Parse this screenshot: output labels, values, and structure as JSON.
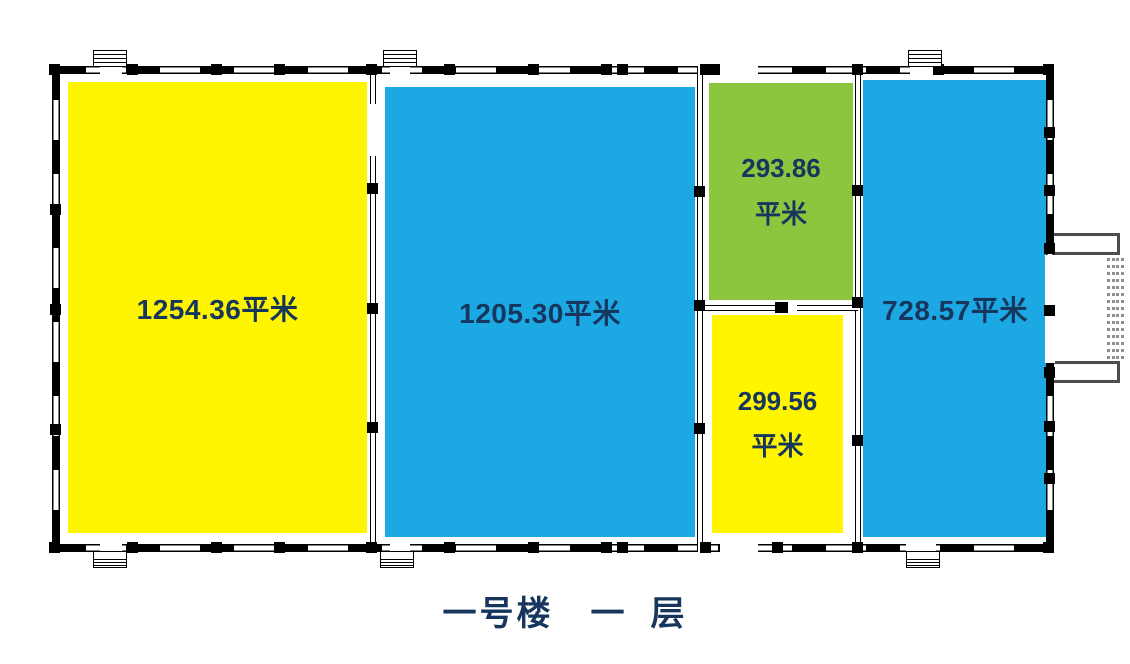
{
  "title": {
    "text": "一号楼　一  层",
    "color": "#17365D"
  },
  "colors": {
    "label": "#17365D",
    "wall": "#000000",
    "canopy_gray": "#4d4d4d",
    "dock_dots_gray": "#8f8f8f",
    "yellow": "#FFF500",
    "blue": "#1CA9E3",
    "green": "#8CC63F"
  },
  "rooms": [
    {
      "id": "room-1",
      "area": "1254.36",
      "unit": "平米",
      "fill": "#FFF500"
    },
    {
      "id": "room-2",
      "area": "1205.30",
      "unit": "平米",
      "fill": "#1CA9E3"
    },
    {
      "id": "room-3",
      "area": "293.86",
      "unit": "平米",
      "fill": "#8CC63F"
    },
    {
      "id": "room-4",
      "area": "299.56",
      "unit": "平米",
      "fill": "#FFF500"
    },
    {
      "id": "room-5",
      "area": "728.57",
      "unit": "平米",
      "fill": "#1CA9E3"
    }
  ]
}
